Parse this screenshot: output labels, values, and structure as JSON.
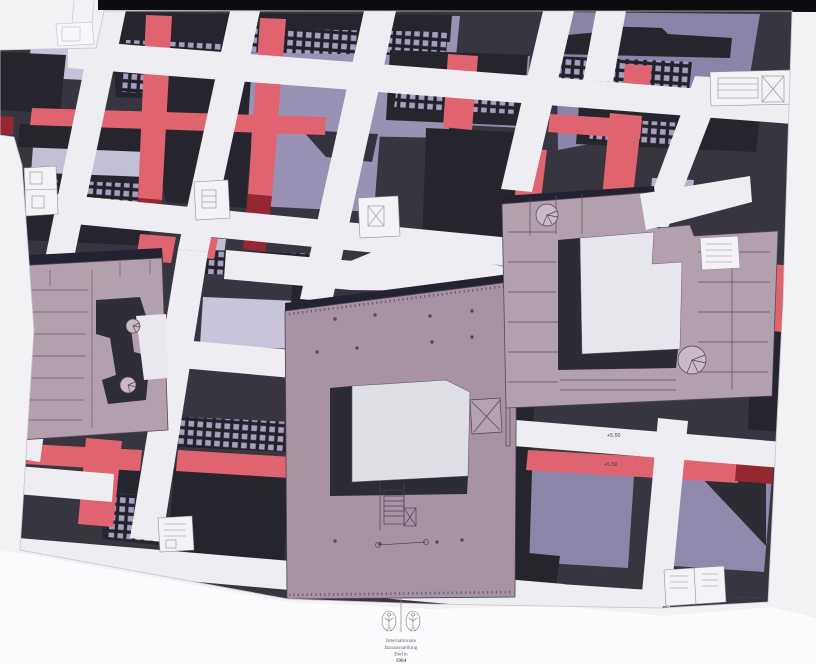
{
  "artwork": {
    "logo": {
      "line1": "Internationale",
      "line2": "Bauausstellung",
      "line3": "Berlin",
      "line4": "1984"
    },
    "annotations": {
      "level_1": "+5.50",
      "level_2": "+5.50",
      "level_3": "+1.50"
    },
    "credit": "·· ····· ·······",
    "palette": {
      "paper_margin": "#f2f1f4",
      "bottom_margin": "#fcfbfd",
      "top_bar_black": "#0d0d11",
      "block_dark": "#26252e",
      "window_lavender": "#a79fc0",
      "lavender_roof": "#c5c2d8",
      "purple_field": "#9a92b4",
      "purple_parallelogram": "#8b83a8",
      "street_red": "#df6470",
      "street_red_dark": "#962630",
      "street_white": "#eeedf1",
      "building_mauve": "#b2a0af",
      "building_mauve_center": "#a793a4",
      "courtyard_light": "#e3e2e9",
      "shadow_dark": "#2d2c35"
    }
  }
}
